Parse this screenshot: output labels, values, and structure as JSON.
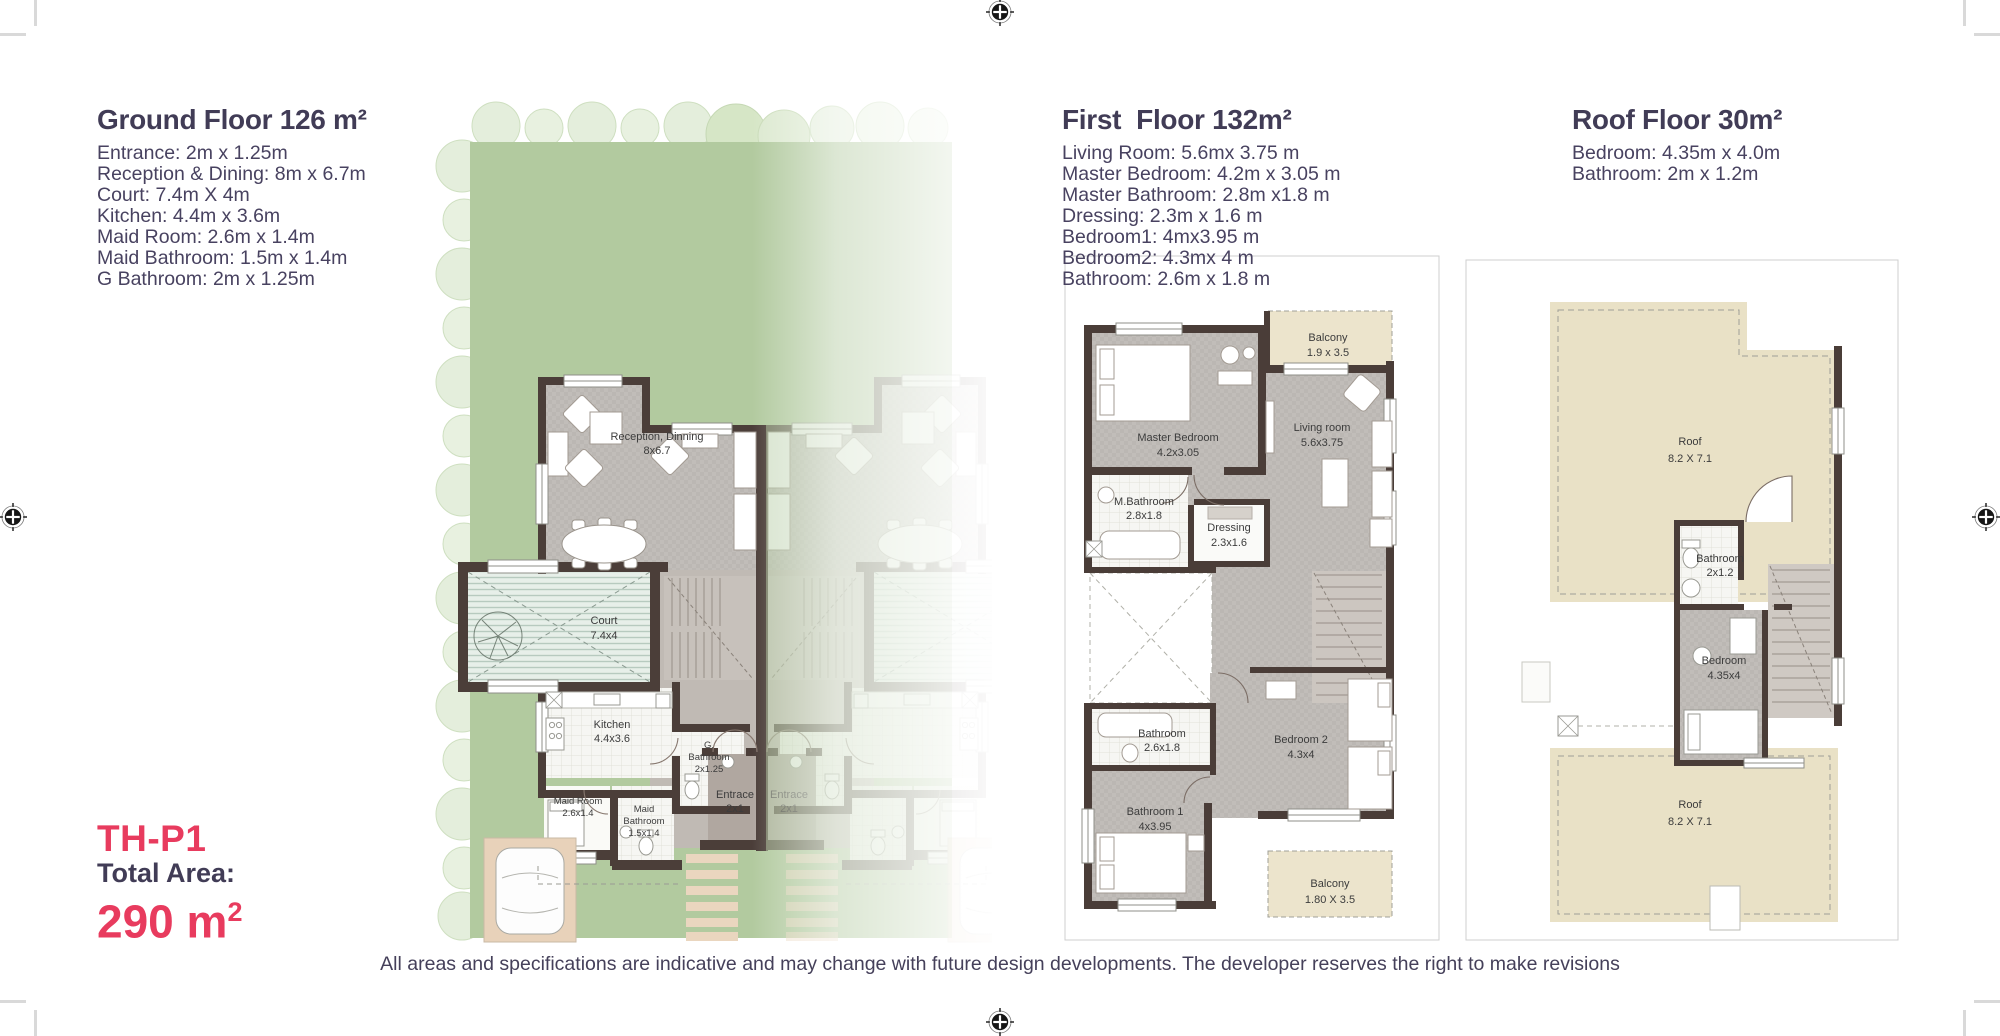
{
  "floors": [
    {
      "title": "Ground Floor 126 m²",
      "rooms": [
        "Entrance: 2m x 1.25m",
        "Reception & Dining: 8m x 6.7m",
        "Court: 7.4m X 4m",
        "Kitchen: 4.4m x 3.6m",
        "Maid Room: 2.6m x 1.4m",
        "Maid Bathroom: 1.5m x 1.4m",
        "G Bathroom: 2m x 1.25m"
      ]
    },
    {
      "title": "First  Floor 132m²",
      "rooms": [
        "Living Room: 5.6mx 3.75 m",
        "Master Bedroom: 4.2m x 3.05 m",
        "Master Bathroom: 2.8m x1.8 m",
        "Dressing: 2.3m x 1.6 m",
        "Bedroom1: 4mx3.95 m",
        "Bedroom2: 4.3mx 4 m",
        "Bathroom: 2.6m x 1.8 m"
      ]
    },
    {
      "title": "Roof Floor 30m²",
      "rooms": [
        "Bedroom: 4.35m x 4.0m",
        "Bathroom: 2m x 1.2m"
      ]
    }
  ],
  "unit": {
    "code": "TH-P1",
    "total_area_label": "Total Area:",
    "total_area_value": "290 m",
    "total_area_sup": "2"
  },
  "disclaimer": "All areas and specifications are indicative and may change with future design developments. The developer reserves the right to make revisions",
  "plan_labels": {
    "ground": {
      "reception_name": "Reception, Dinning",
      "reception_dim": "8x6.7",
      "court_name": "Court",
      "court_dim": "7.4x4",
      "kitchen_name": "Kitchen",
      "kitchen_dim": "4.4x3.6",
      "maid_room_name": "Maid Room",
      "maid_room_dim": "2.6x1.4",
      "maid_bath_line1": "Maid",
      "maid_bath_line2": "Bathroom",
      "maid_bath_dim": "1.5x1.4",
      "g_bath_line1": "G.",
      "g_bath_line2": "Bathroom",
      "g_bath_dim": "2x1.25",
      "entrance_name": "Entrace",
      "entrance_dim": "2x1"
    },
    "first": {
      "balcony_top_name": "Balcony",
      "balcony_top_dim": "1.9 x 3.5",
      "master_name": "Master Bedroom",
      "master_dim": "4.2x3.05",
      "living_name": "Living room",
      "living_dim": "5.6x3.75",
      "mbath_name": "M.Bathroom",
      "mbath_dim": "2.8x1.8",
      "dressing_name": "Dressing",
      "dressing_dim": "2.3x1.6",
      "bath_name": "Bathroom",
      "bath_dim": "2.6x1.8",
      "bedroom2_name": "Bedroom 2",
      "bedroom2_dim": "4.3x4",
      "bedroom1_name": "Bathroom 1",
      "bedroom1_dim": "4x3.95",
      "balcony_bottom_name": "Balcony",
      "balcony_bottom_dim": "1.80 X 3.5"
    },
    "roof": {
      "roof_top_name": "Roof",
      "roof_top_dim": "8.2 X 7.1",
      "bath_name": "Bathroom",
      "bath_dim": "2x1.2",
      "bedroom_name": "Bedroom",
      "bedroom_dim": "4.35x4",
      "roof_bottom_name": "Roof",
      "roof_bottom_dim": "8.2 X 7.1"
    }
  },
  "colors": {
    "accent_pink": "#e83b5e",
    "heading": "#413c56",
    "body_text": "#484260",
    "wall": "#4b3e39",
    "lawn": "#b2ca9f",
    "court": "#e7efe9",
    "balcony": "#ece4cc",
    "floor_gray": "#bbb7b3"
  }
}
